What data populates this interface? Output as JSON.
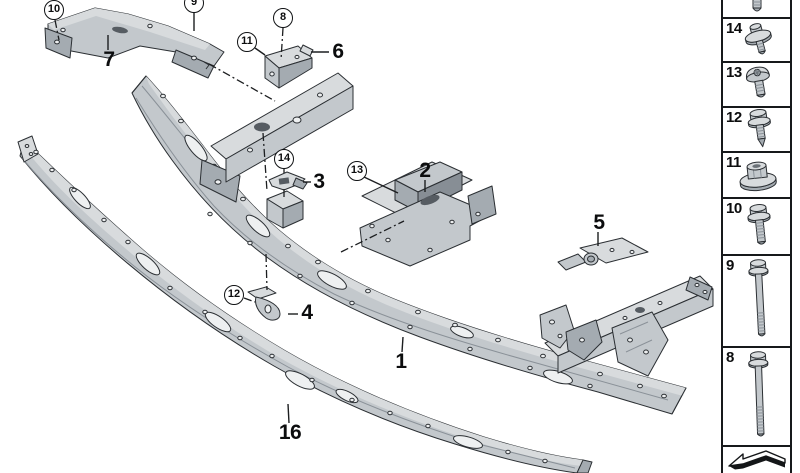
{
  "canvas": {
    "width": 800,
    "height": 473,
    "background": "#ffffff"
  },
  "colors": {
    "outline": "#2b2f33",
    "part_light": "#d8dbdd",
    "part_mid": "#c3c8cc",
    "part_shade": "#a4abb1",
    "part_dark": "#878e95",
    "hole_dark": "#565c62",
    "leader_line": "#1c1e20",
    "legend_border": "#17191b",
    "callout_border": "#101214"
  },
  "main": {
    "callouts": [
      {
        "id": "10"
      },
      {
        "id": "9"
      },
      {
        "id": "8"
      },
      {
        "id": "11"
      },
      {
        "id": "14"
      },
      {
        "id": "13"
      },
      {
        "id": "12"
      }
    ],
    "labels": [
      {
        "text": "7"
      },
      {
        "text": "6"
      },
      {
        "text": "3"
      },
      {
        "text": "2"
      },
      {
        "text": "5"
      },
      {
        "text": "4"
      },
      {
        "text": "1"
      },
      {
        "text": "16"
      }
    ]
  },
  "legend": {
    "items": [
      {
        "number": "",
        "icon": "bolt-shaft-partial-icon"
      },
      {
        "number": "14",
        "icon": "washer-screw-icon"
      },
      {
        "number": "13",
        "icon": "torx-pan-head-screw-icon"
      },
      {
        "number": "12",
        "icon": "hex-flange-bolt-tapered-icon"
      },
      {
        "number": "11",
        "icon": "flange-nut-icon"
      },
      {
        "number": "10",
        "icon": "hex-flange-screw-icon"
      },
      {
        "number": "9",
        "icon": "hex-flange-bolt-long-icon"
      },
      {
        "number": "8",
        "icon": "hex-flange-bolt-extra-long-icon"
      },
      {
        "number": "",
        "icon": "direction-of-travel-arrow-icon"
      }
    ]
  }
}
